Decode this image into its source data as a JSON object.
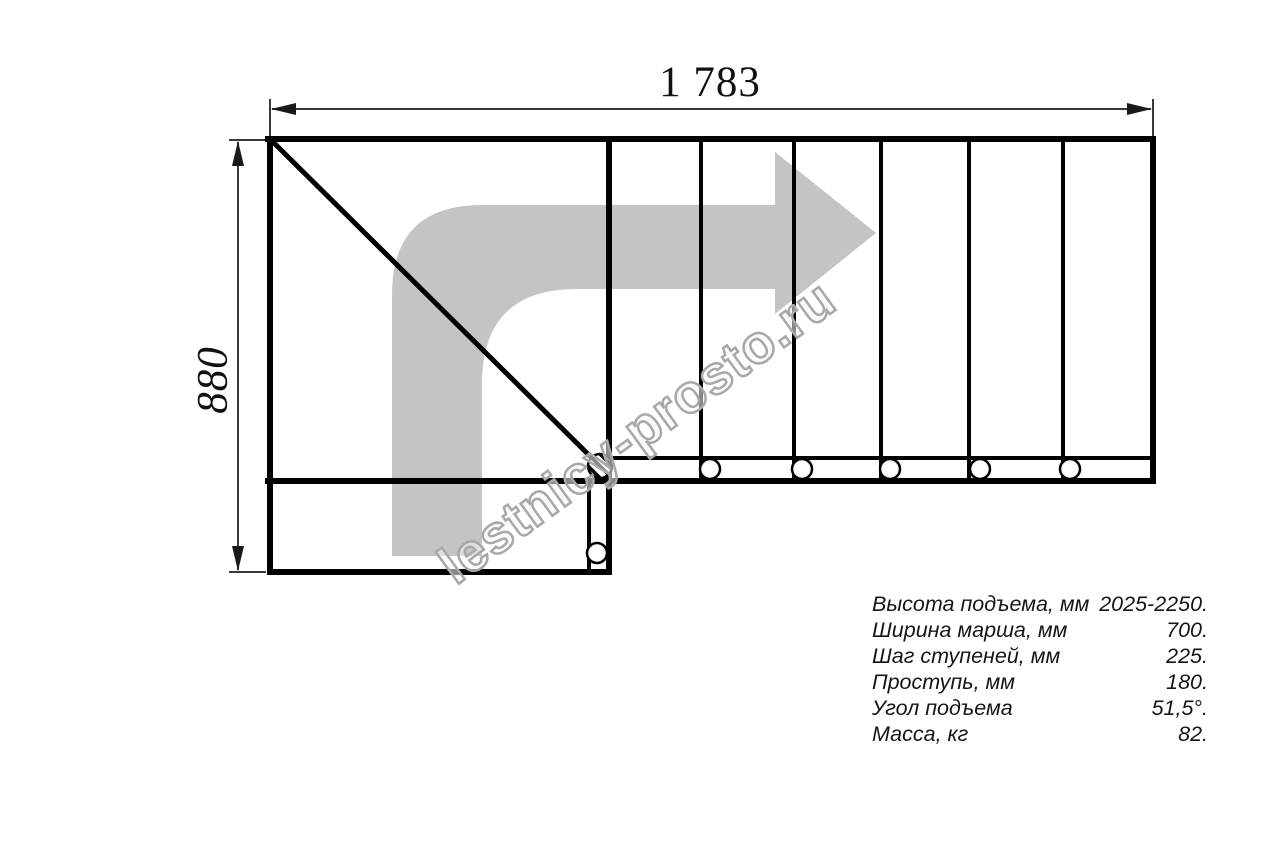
{
  "watermark": "lestnicy-prosto.ru",
  "dimensions": {
    "width_mm": "1 783",
    "height_mm": "880"
  },
  "specs": {
    "rows": [
      {
        "label": "Высота подъема, мм",
        "value": "2025-2250."
      },
      {
        "label": "Ширина марша, мм",
        "value": "700."
      },
      {
        "label": "Шаг ступеней, мм",
        "value": "225."
      },
      {
        "label": "Проступь, мм",
        "value": "180."
      },
      {
        "label": "Угол подъема",
        "value": "51,5°."
      },
      {
        "label": "Масса, кг",
        "value": "82."
      }
    ]
  },
  "colors": {
    "line": "#000000",
    "dimension_line": "#3a3a3a",
    "arrow_fill": "#c4c4c4",
    "watermark_stroke": "#a8a8a8"
  }
}
